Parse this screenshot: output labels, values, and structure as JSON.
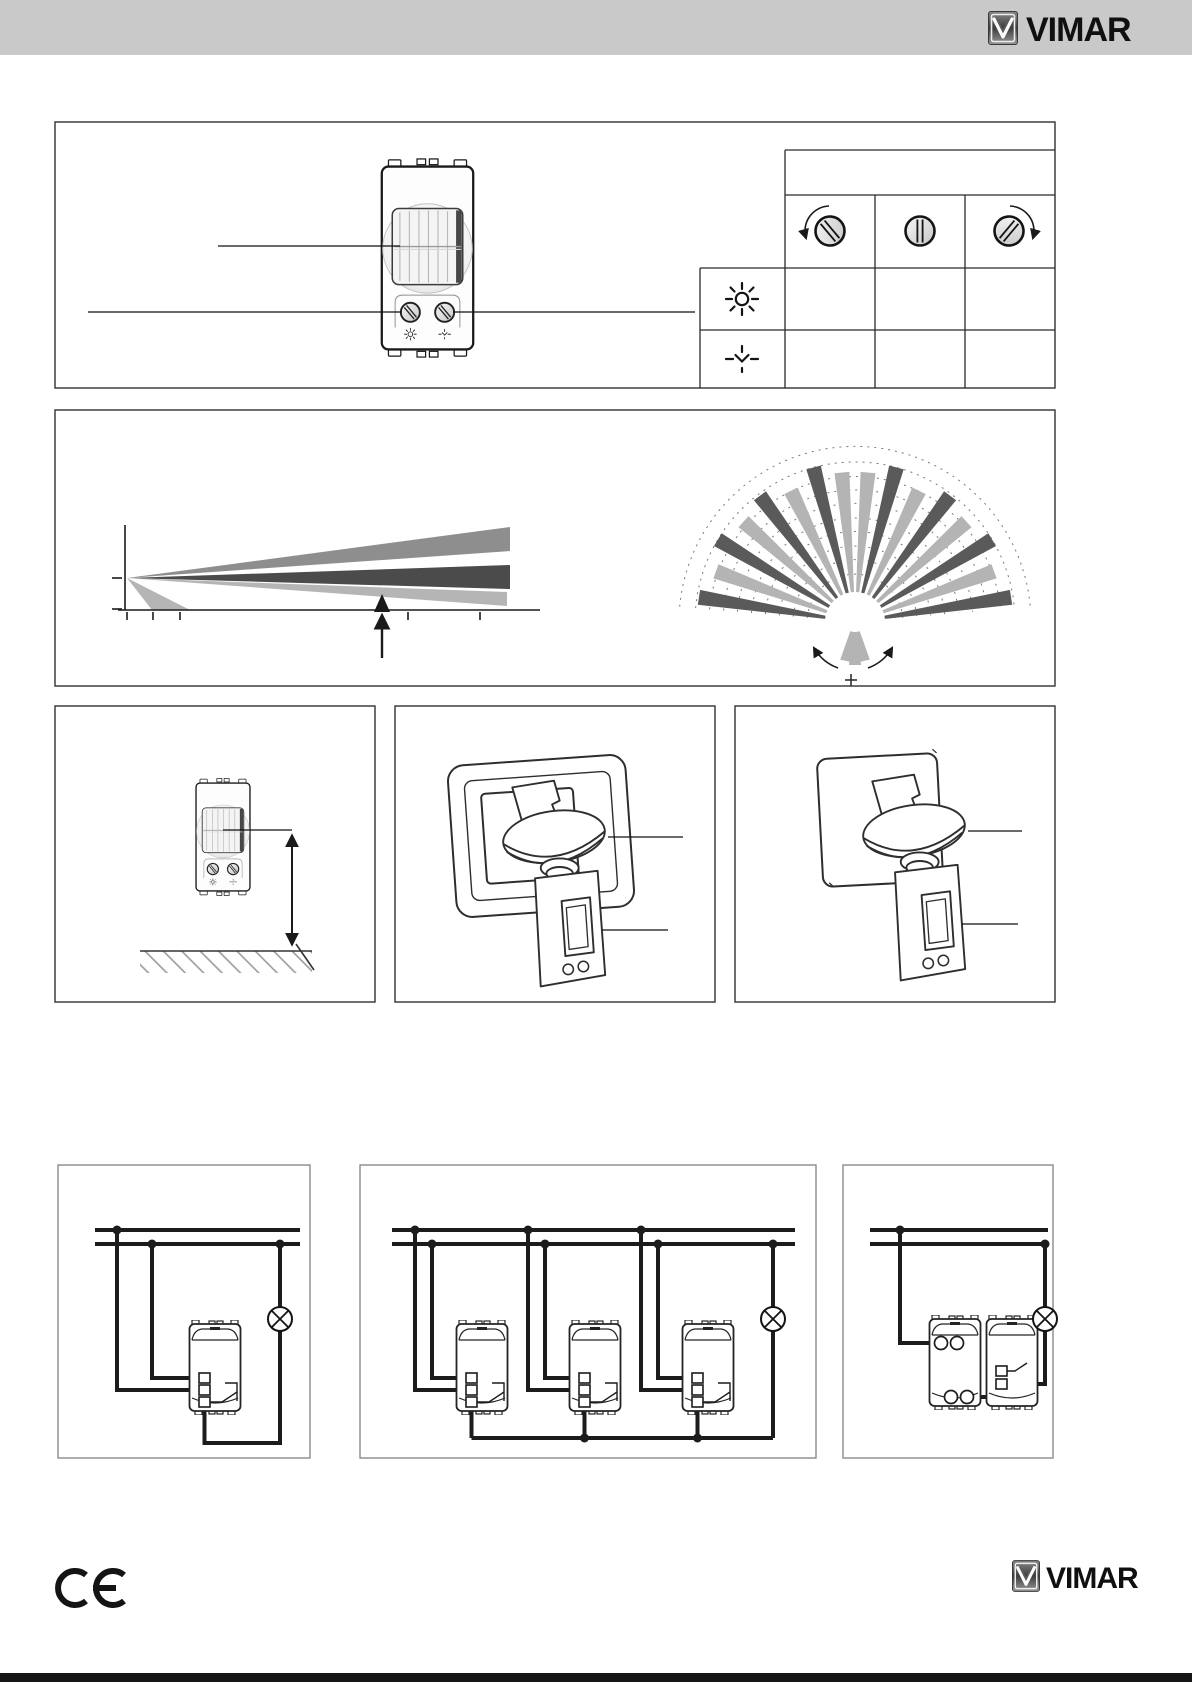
{
  "header": {
    "brand": "VIMAR"
  },
  "footer": {
    "brand": "VIMAR",
    "ce_label": "CE"
  },
  "palette": {
    "header_bar": "#c9c9c9",
    "box_border": "#3f3f3f",
    "wiring_box_border": "#8a8a8a",
    "wire": "#1c1c1c",
    "beam_dark": "#5a5a5a",
    "beam_mid": "#4b4b4b",
    "beam_light": "#b4b4b4",
    "beam_gray": "#8e8e8e",
    "footer_bar": "#151515"
  },
  "adjustment_table": {
    "columns": [
      "knob-ccw",
      "knob-mid",
      "knob-cw"
    ],
    "rows": [
      "sun",
      "twilight"
    ],
    "cell_values": [
      [
        "",
        "",
        ""
      ],
      [
        "",
        "",
        ""
      ]
    ]
  },
  "fan": {
    "cx": 855,
    "cy": 622,
    "inner": 30,
    "base_half_width": 1.6,
    "tip_half_width": 7.5,
    "dark": "#5a5a5a",
    "light": "#b4b4b4",
    "arc_radii": [
      48,
      62,
      76,
      90,
      104,
      118,
      132,
      146,
      160,
      176
    ],
    "beams": [
      {
        "a": -81,
        "r": 158,
        "c": "d"
      },
      {
        "a": -70,
        "r": 148,
        "c": "l"
      },
      {
        "a": -59,
        "r": 160,
        "c": "d"
      },
      {
        "a": -48,
        "r": 150,
        "c": "l"
      },
      {
        "a": -37,
        "r": 158,
        "c": "d"
      },
      {
        "a": -26,
        "r": 146,
        "c": "l"
      },
      {
        "a": -15,
        "r": 160,
        "c": "d"
      },
      {
        "a": -5,
        "r": 150,
        "c": "l"
      },
      {
        "a": 5,
        "r": 150,
        "c": "l"
      },
      {
        "a": 15,
        "r": 160,
        "c": "d"
      },
      {
        "a": 26,
        "r": 146,
        "c": "l"
      },
      {
        "a": 37,
        "r": 158,
        "c": "d"
      },
      {
        "a": 48,
        "r": 150,
        "c": "l"
      },
      {
        "a": 59,
        "r": 160,
        "c": "d"
      },
      {
        "a": 70,
        "r": 148,
        "c": "l"
      },
      {
        "a": 81,
        "r": 158,
        "c": "d"
      }
    ],
    "down_beams": [
      {
        "a": 167,
        "r": 40
      },
      {
        "a": 180,
        "r": 43
      },
      {
        "a": 193,
        "r": 40
      }
    ]
  },
  "side_view": {
    "origin": [
      127,
      578
    ],
    "beams": [
      {
        "c": "#8e8e8e",
        "pts": [
          [
            127,
            578
          ],
          [
            510,
            527
          ],
          [
            510,
            551
          ]
        ]
      },
      {
        "c": "#4b4b4b",
        "pts": [
          [
            127,
            578
          ],
          [
            510,
            565
          ],
          [
            510,
            589
          ]
        ]
      },
      {
        "c": "#b5b5b5",
        "pts": [
          [
            127,
            578
          ],
          [
            507,
            592
          ],
          [
            507,
            606
          ]
        ]
      },
      {
        "c": "#b5b5b5",
        "pts": [
          [
            127,
            578
          ],
          [
            190,
            610
          ],
          [
            152,
            610
          ]
        ]
      }
    ],
    "axis_ticks_x": [
      127,
      153,
      180,
      408,
      480
    ],
    "axis_ticks_y": [
      578,
      609
    ]
  }
}
